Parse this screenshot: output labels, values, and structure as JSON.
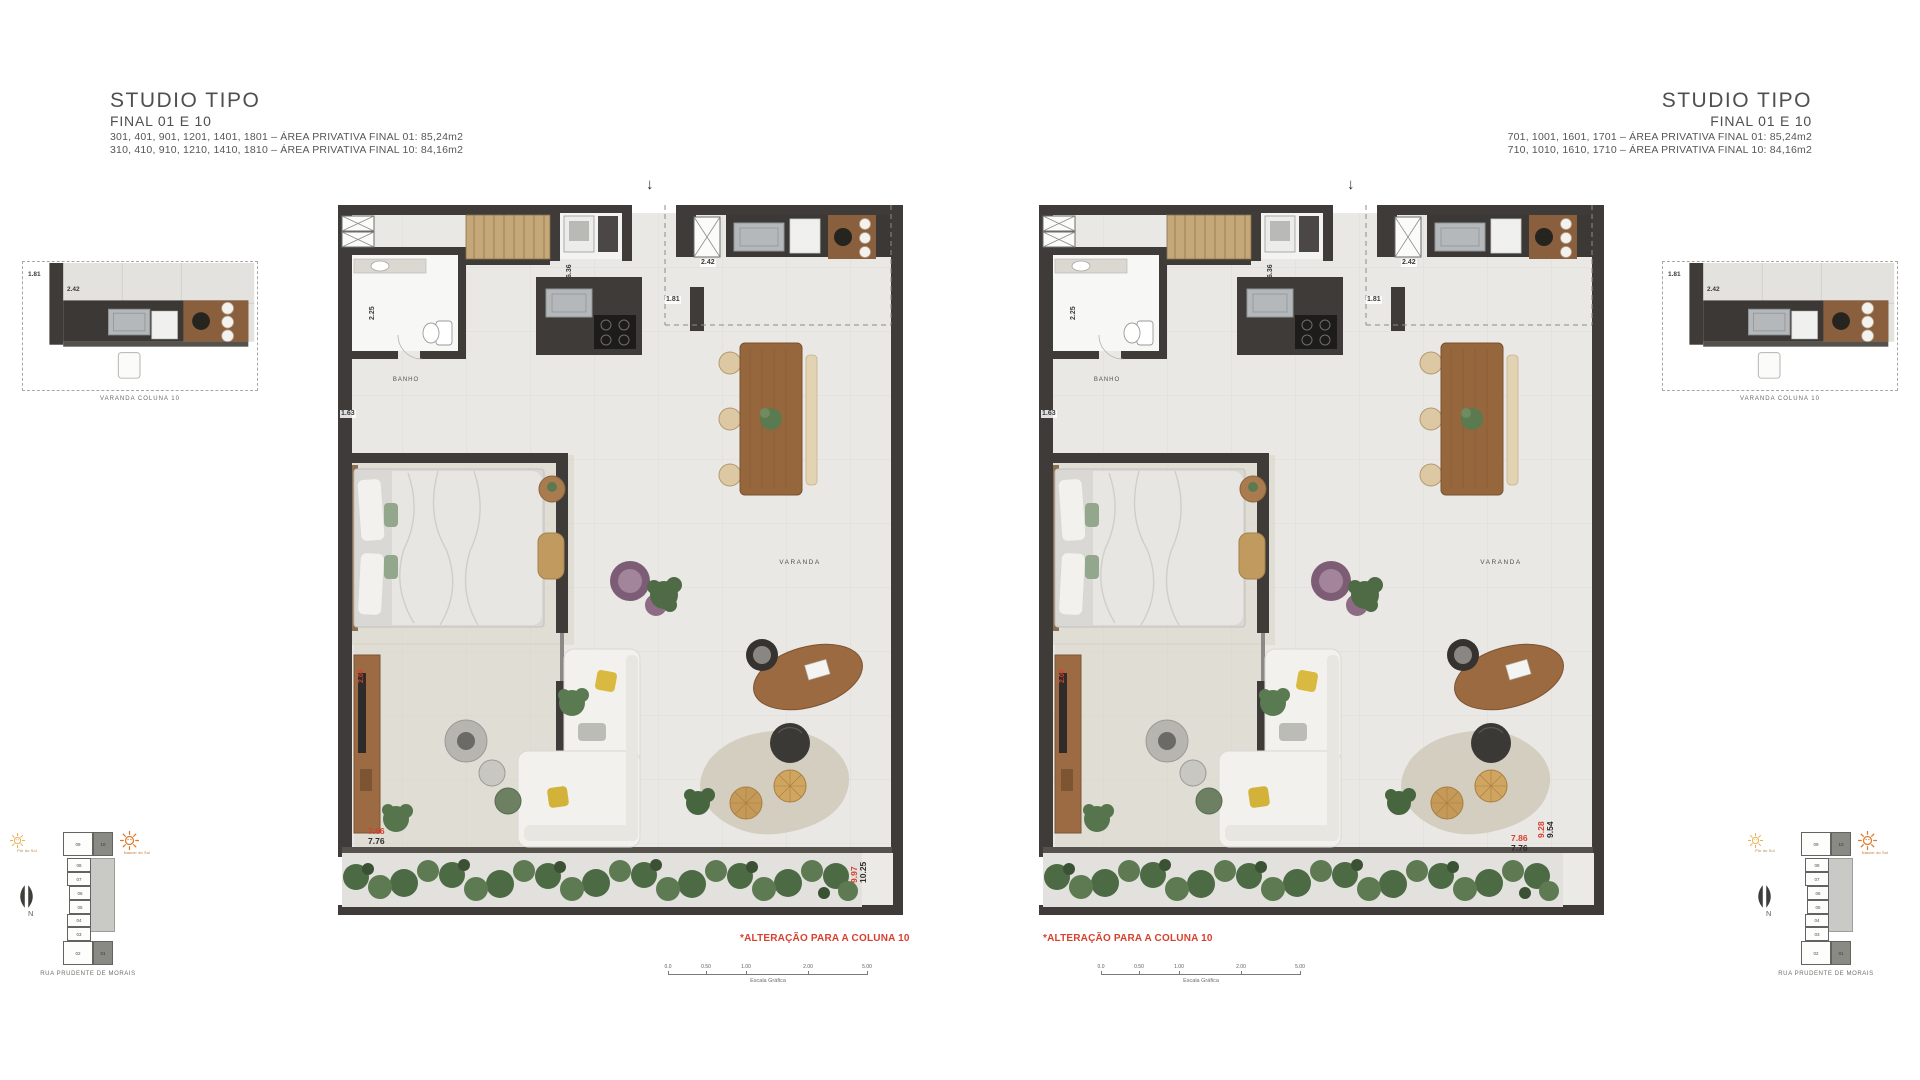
{
  "header_left": {
    "title": "STUDIO TIPO",
    "subtitle": "FINAL 01 E 10",
    "line1": "301, 401, 901, 1201, 1401, 1801 – ÁREA PRIVATIVA FINAL 01: 85,24m2",
    "line2": "310, 410, 910, 1210, 1410, 1810 – ÁREA PRIVATIVA FINAL 10: 84,16m2"
  },
  "header_right": {
    "title": "STUDIO TIPO",
    "subtitle": "FINAL 01 E 10",
    "line1": "701, 1001, 1601, 1701 – ÁREA PRIVATIVA FINAL 01: 85,24m2",
    "line2": "710, 1010, 1610, 1710 – ÁREA PRIVATIVA FINAL 10: 84,16m2"
  },
  "inset_left": {
    "caption": "VARANDA COLUNA 10",
    "dim_height": "1.81",
    "dim_width": "2.42"
  },
  "inset_right": {
    "caption": "VARANDA COLUNA 10",
    "dim_height": "1.81",
    "dim_width": "2.42"
  },
  "plan_left": {
    "entry_arrow": "↓",
    "room_banho": "BANHO",
    "room_varanda": "VARANDA",
    "dim_636": "6.36",
    "dim_225": "2.25",
    "dim_242": "2.42",
    "dim_181": "1.81",
    "dim_163": "1.63",
    "dim_red_side": "2.08",
    "dim_red_bottom": "7.66",
    "dim_bottom": "7.76",
    "dim_red_right": "9.97",
    "dim_right": "10.25",
    "note": "*ALTERAÇÃO PARA A COLUNA 10"
  },
  "plan_right": {
    "entry_arrow": "↓",
    "room_banho": "BANHO",
    "room_varanda": "VARANDA",
    "dim_636": "6.36",
    "dim_225": "2.25",
    "dim_242": "2.42",
    "dim_181": "1.81",
    "dim_163": "1.63",
    "dim_red_side": "2.08",
    "dim_red_bottom": "7.86",
    "dim_bottom": "7.76",
    "dim_red_right": "9.28",
    "dim_right": "9.54",
    "note": "*ALTERAÇÃO PARA A COLUNA 10"
  },
  "scale_bar": {
    "ticks": [
      "0.0",
      "0.50",
      "1.00",
      "2.00",
      "5.00"
    ],
    "caption": "Escala Gráfica"
  },
  "key_left": {
    "street": "RUA PRUDENTE DE MORAIS",
    "north_label": "N",
    "sun_west_label": "Pôr do Sol",
    "sun_east_label": "Nascer do Sol",
    "units": {
      "u09": "09",
      "u10": "10",
      "u08": "08",
      "u07": "07",
      "u06": "06",
      "u05": "05",
      "u04": "04",
      "u03": "03",
      "u02": "02",
      "u01": "01"
    }
  },
  "key_right": {
    "street": "RUA PRUDENTE DE MORAIS",
    "north_label": "N",
    "sun_west_label": "Pôr do Sol",
    "sun_east_label": "Nascer do Sol",
    "units": {
      "u09": "09",
      "u10": "10",
      "u08": "08",
      "u07": "07",
      "u06": "06",
      "u05": "05",
      "u04": "04",
      "u03": "03",
      "u02": "02",
      "u01": "01"
    }
  },
  "colors": {
    "wall": "#3e3b38",
    "floor": "#e9e8e5",
    "red_annotation": "#d8402e",
    "wood": "#9b6a41",
    "sun_pale": "#ecb054",
    "sun_strong": "#dd7a2c",
    "hedge_green": "#4c6a43"
  }
}
